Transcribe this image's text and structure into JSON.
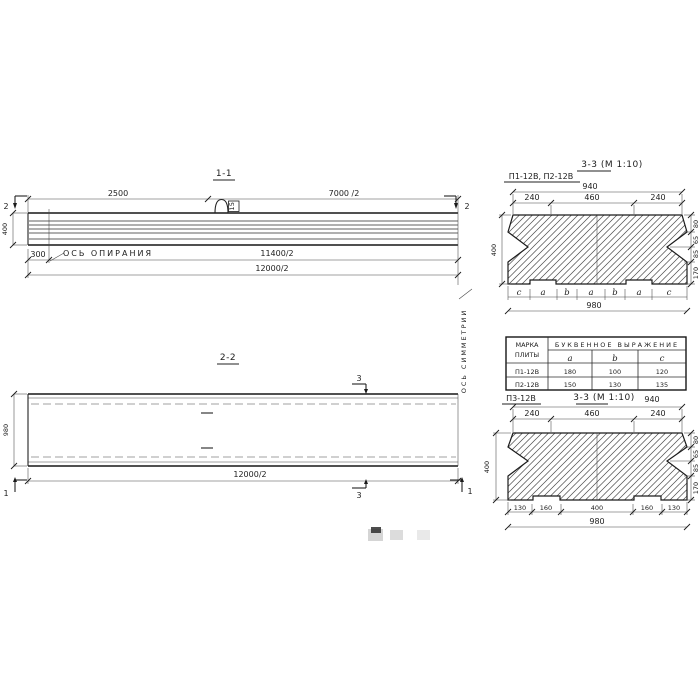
{
  "doc": {
    "s11": {
      "title": "1-1",
      "cut2": "2",
      "dim_2500": "2500",
      "dim_7000": "7000 /2",
      "dim_400": "400",
      "dim_300": "300",
      "support_axis": "ОСЬ ОПИРАНИЯ",
      "dim_11400": "11400/2",
      "dim_12000": "12000/2",
      "loop_tag": "15"
    },
    "sym_axis": "ОСЬ СИММЕТРИИ",
    "s22": {
      "title": "2-2",
      "cut3": "3",
      "cut1": "1",
      "dim_980": "980",
      "dim_12000": "12000/2"
    },
    "s33a": {
      "title": "3-3 (М 1:10)",
      "marks": "П1-12В, П2-12В",
      "dim_940": "940",
      "seg_240l": "240",
      "seg_460": "460",
      "seg_240r": "240",
      "dim_400": "400",
      "r80": "80",
      "r65": "65",
      "r85": "85",
      "r170": "170",
      "letters": [
        "c",
        "a",
        "b",
        "a",
        "b",
        "a",
        "c"
      ],
      "dim_980": "980"
    },
    "table": {
      "h_mark_1": "МАРКА",
      "h_mark_2": "ПЛИТЫ",
      "h_span": "БУКВЕННОЕ ВЫРАЖЕНИЕ",
      "h_a": "a",
      "h_b": "b",
      "h_c": "c",
      "rows": [
        {
          "mark": "П1-12В",
          "a": "180",
          "b": "100",
          "c": "120"
        },
        {
          "mark": "П2-12В",
          "a": "150",
          "b": "130",
          "c": "135"
        }
      ]
    },
    "s33b": {
      "mark": "П3-12В",
      "title": "3-3 (М 1:10)",
      "dim_940": "940",
      "seg_240l": "240",
      "seg_460": "460",
      "seg_240r": "240",
      "dim_400": "400",
      "r80": "80",
      "r65": "65",
      "r85": "85",
      "r170": "170",
      "b130l": "130",
      "b160l": "160",
      "b400": "400",
      "b160r": "160",
      "b130r": "130",
      "dim_980": "980"
    }
  }
}
